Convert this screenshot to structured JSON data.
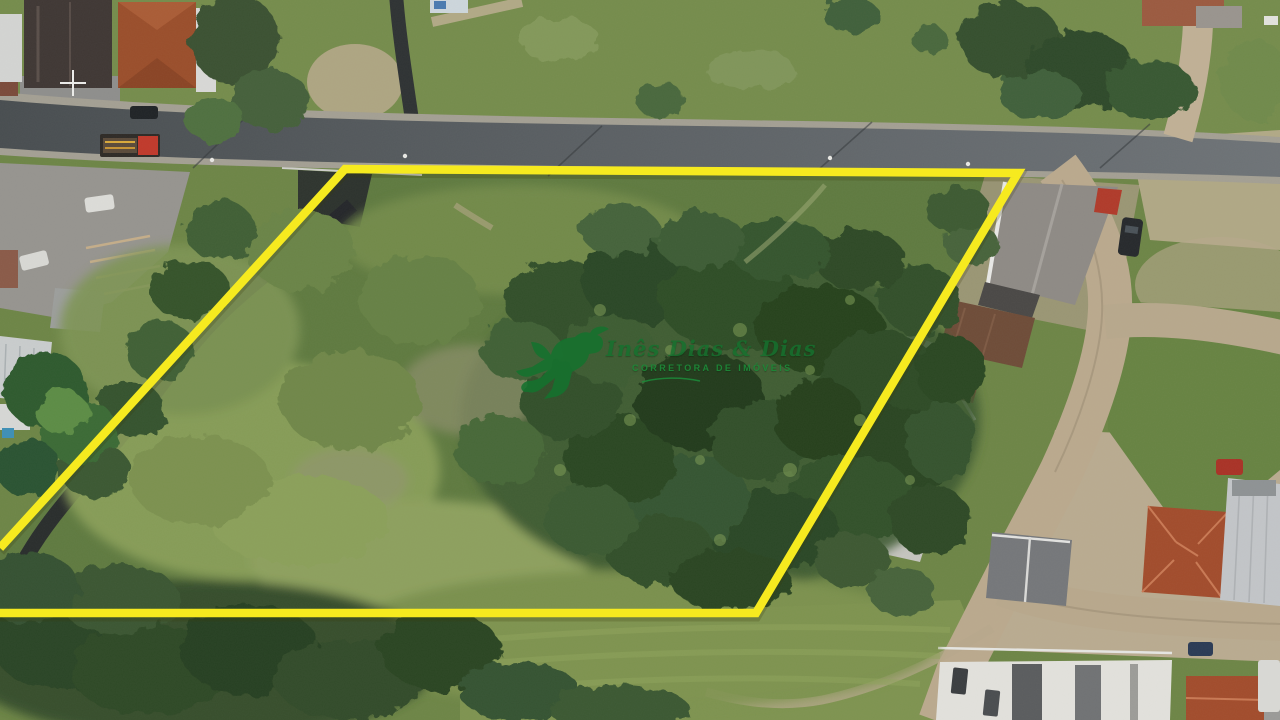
{
  "watermark": {
    "brand_script": "Inês Dias & Dias",
    "brand_subtitle": "CORRETORA DE IMÓVEIS",
    "logo_icon": "hummingbird-icon"
  },
  "colors": {
    "boundary_yellow": "#f6ea1f",
    "logo_green": "#15722e",
    "subtitle_green": "#1d8838"
  }
}
